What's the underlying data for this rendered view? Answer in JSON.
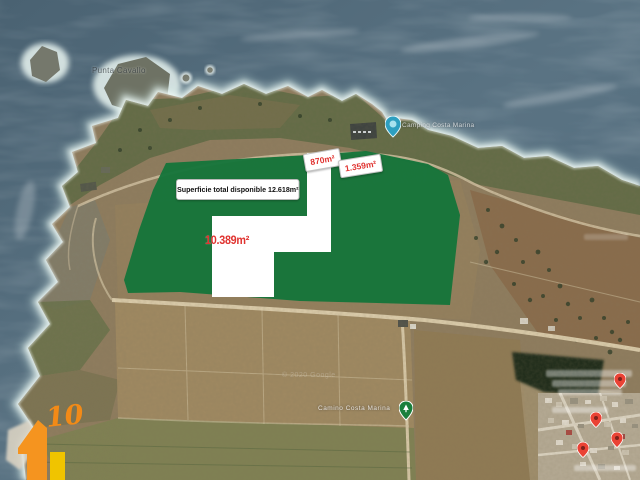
{
  "map": {
    "description": "Aerial satellite view of a coastal headland with annotated land plots for sale",
    "labels": {
      "headland": "Punta Cavallo",
      "poi": "Camping Costa Marina",
      "road": "Camino Costa Marina",
      "watermark": "© 2020 Google"
    },
    "markers": {
      "blue_pin_color": "#2d9fc0",
      "green_pin_color": "#1a7f3c",
      "red_pin_color": "#ea4335",
      "red_pin_count": 4
    }
  },
  "overlay": {
    "total_label": "Superficie total disponible 12.618m²",
    "main_area": "10.389m²",
    "small_area_1": "870m²",
    "small_area_2": "1.359m²",
    "green_color": "#15753a",
    "red_text_color": "#e0322f"
  },
  "logo": {
    "number": "10",
    "orange_color": "#f5941f",
    "yellow_color": "#f0c400"
  }
}
